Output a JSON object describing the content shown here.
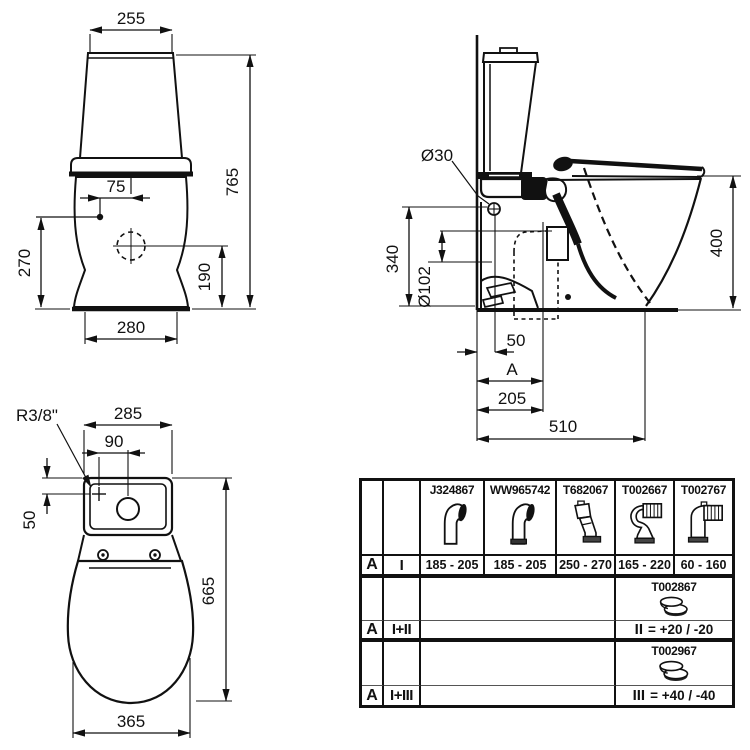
{
  "front_view": {
    "tank_width": "255",
    "total_height": "765",
    "supply_offset": "75",
    "supply_height": "270",
    "flush_center_height": "190",
    "base_width": "280"
  },
  "side_view": {
    "supply_diameter": "Ø30",
    "supply_height": "340",
    "outlet_diameter": "Ø102",
    "rim_height": "400",
    "supply_wall_offset": "50",
    "rough_in_label": "A",
    "rough_in_value": "205",
    "depth": "510"
  },
  "top_view": {
    "supply_thread": "R3/8\"",
    "tank_width": "285",
    "supply_center_offset": "90",
    "supply_edge_offset": "50",
    "total_depth": "665",
    "seat_width": "365"
  },
  "table": {
    "row_label": "A",
    "config_1": "I",
    "config_2": "I+II",
    "config_3": "I+III",
    "parts": [
      {
        "code": "J324867",
        "icon": "offset-connector-icon",
        "range": "185 - 205"
      },
      {
        "code": "WW965742",
        "icon": "offset-connector-gasket-icon",
        "range": "185 - 205"
      },
      {
        "code": "T682067",
        "icon": "angled-connector-icon",
        "range": "250 - 270"
      },
      {
        "code": "T002667",
        "icon": "flexible-s-connector-icon",
        "range": "165 - 220"
      },
      {
        "code": "T002767",
        "icon": "flexible-elbow-connector-icon",
        "range": "60 - 160"
      }
    ],
    "adapter_2": {
      "code": "T002867",
      "icon": "offset-ring-adapter-icon"
    },
    "adapter_3": {
      "code": "T002967",
      "icon": "offset-ring-adapter-icon"
    },
    "offset_2_label": "II",
    "offset_2_value": "= +20 / -20",
    "offset_3_label": "III",
    "offset_3_value": "= +40 / -40"
  },
  "colors": {
    "ink": "#111111",
    "paper": "#ffffff"
  }
}
